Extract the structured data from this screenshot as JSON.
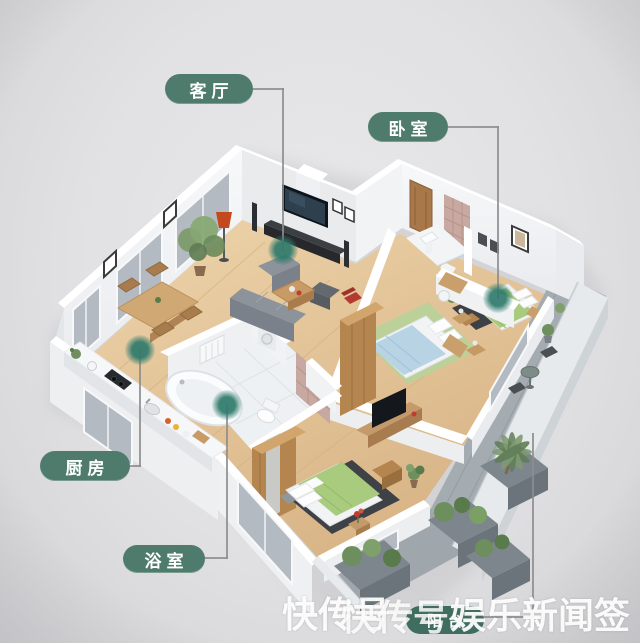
{
  "labels": {
    "living_room": "客厅",
    "bedroom": "卧室",
    "kitchen": "厨房",
    "bathroom": "浴室",
    "balcony": "阳台"
  },
  "watermark": {
    "layer1": "快传号",
    "layer2": "快传号",
    "layer3": "娱乐新闻签"
  },
  "colors": {
    "label_pill": "#4e7b6c",
    "anchor_dot": "#2f7a6b",
    "connector_line": "#8d8d8d",
    "watermark_pill": "#3f6e5f",
    "watermark_text": "#ffffff",
    "background": "#e1e1e3"
  }
}
